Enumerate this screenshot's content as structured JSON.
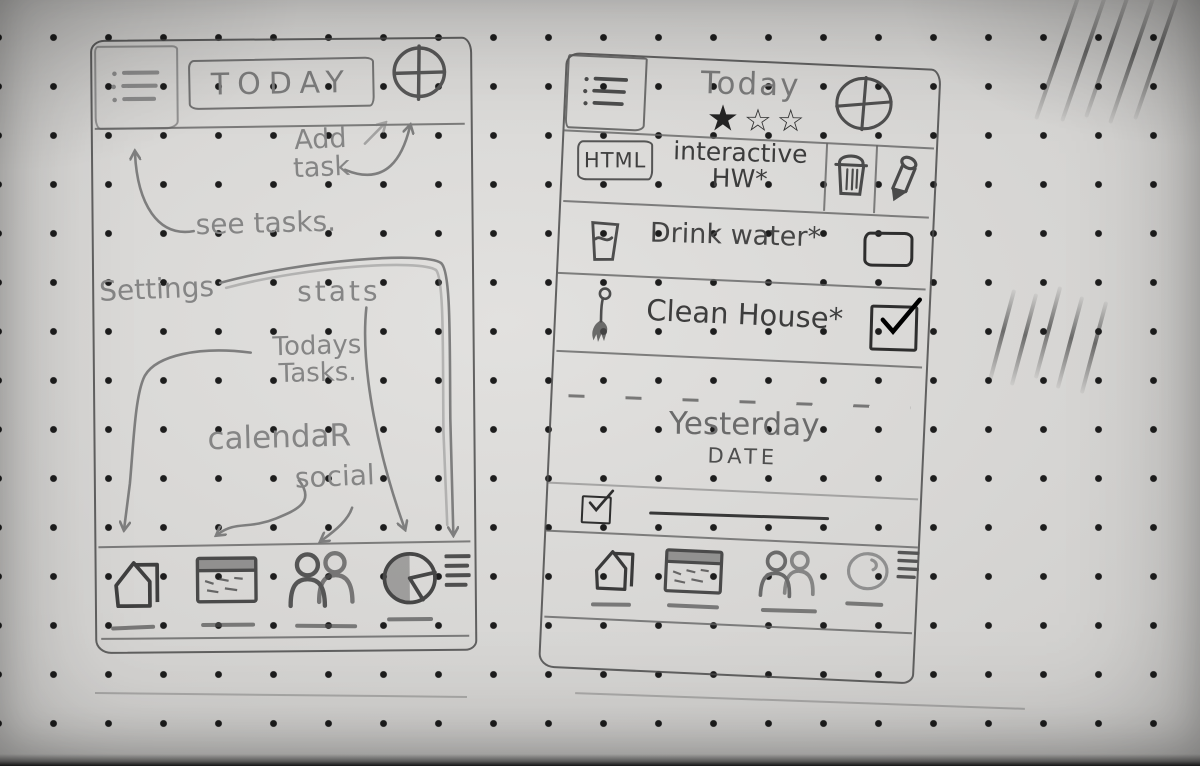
{
  "paper": {
    "background_color": "#d2d1cf",
    "dot_color": "#1d1d1d",
    "pencil_color": "#4a4a4a",
    "annotation_pencil_color": "#858585"
  },
  "left_phone": {
    "header": {
      "menu_icon": "bullet-list",
      "title": "TODAY",
      "add_button_icon": "plus-circle"
    },
    "annotations": {
      "add_task": "Add\ntask",
      "see_tasks": "see tasks.",
      "settings": "Settings",
      "stats": "stats",
      "todays_tasks": "Todays\nTasks.",
      "calendar": "calendaR",
      "social": "social"
    },
    "annotation_arrows": [
      {
        "from": "add_task",
        "to": "add-task-button"
      },
      {
        "from": "see_tasks",
        "to": "menu-button"
      },
      {
        "from": "settings",
        "to": "nav-menu-icon"
      },
      {
        "from": "stats",
        "to": "nav-pie-chart-icon"
      },
      {
        "from": "todays_tasks",
        "to": "nav-home-icon"
      },
      {
        "from": "calendar",
        "to": "nav-calendar-icon"
      },
      {
        "from": "social",
        "to": "nav-people-icon"
      }
    ],
    "nav": {
      "items": [
        {
          "icon": "home"
        },
        {
          "icon": "calendar"
        },
        {
          "icon": "people"
        },
        {
          "icon": "pie-chart"
        },
        {
          "icon": "menu-lines"
        }
      ]
    }
  },
  "right_phone": {
    "header": {
      "menu_icon": "bullet-list",
      "title": "Today",
      "rating": [
        "★",
        "☆",
        "☆"
      ],
      "add_button_icon": "target-plus"
    },
    "tasks": [
      {
        "badge": "HTML",
        "title": "interactive\nHW*",
        "actions": [
          "trash",
          "pencil"
        ]
      },
      {
        "icon": "water-glass",
        "title": "Drink water*",
        "checkbox": "empty"
      },
      {
        "icon": "brush",
        "title": "Clean House*",
        "checkbox": "checked"
      }
    ],
    "yesterday": {
      "title": "Yesterday",
      "subtitle": "DATE"
    },
    "completed_item": {
      "checkbox": "checked",
      "text_placeholder_line": true
    },
    "nav": {
      "items": [
        {
          "icon": "home"
        },
        {
          "icon": "calendar"
        },
        {
          "icon": "people"
        },
        {
          "icon": "circle"
        },
        {
          "icon": "menu-lines"
        }
      ]
    }
  }
}
